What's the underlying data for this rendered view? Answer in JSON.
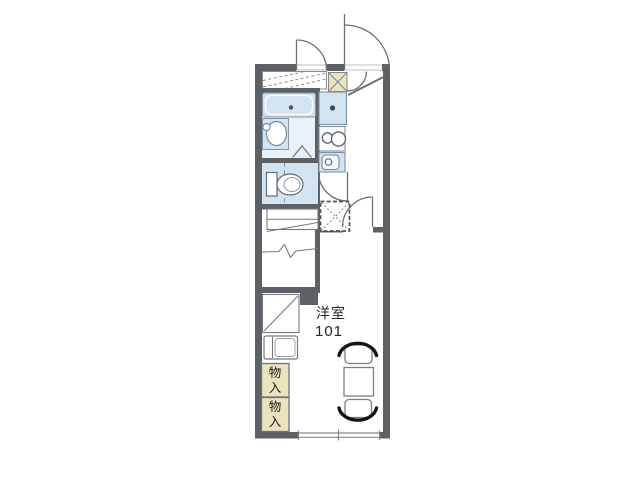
{
  "floorplan": {
    "room": {
      "label": "洋室",
      "number": "101"
    },
    "storage": {
      "labels": [
        "物入",
        "物入"
      ]
    },
    "fixtures": [
      "entrance-door",
      "outside-door",
      "shoe-cabinet",
      "genkan-step-line",
      "balcony-hatch",
      "bathtub",
      "washbasin",
      "bath-folding-door",
      "toilet",
      "kitchen-counter",
      "stove-burners",
      "kitchen-sink",
      "toilet-door",
      "washing-machine-space",
      "staircase",
      "under-stair-closet",
      "refrigerator-space",
      "room-door",
      "storage-closet",
      "storage-closet",
      "dining-table",
      "chair",
      "chair",
      "window"
    ],
    "colors": {
      "wall": "#5d6166",
      "fixture_blue": "#d3e3f1",
      "storage_tan": "#ebe3bd",
      "line": "#75797d",
      "chair_black": "#141414",
      "background": "#ffffff"
    }
  }
}
